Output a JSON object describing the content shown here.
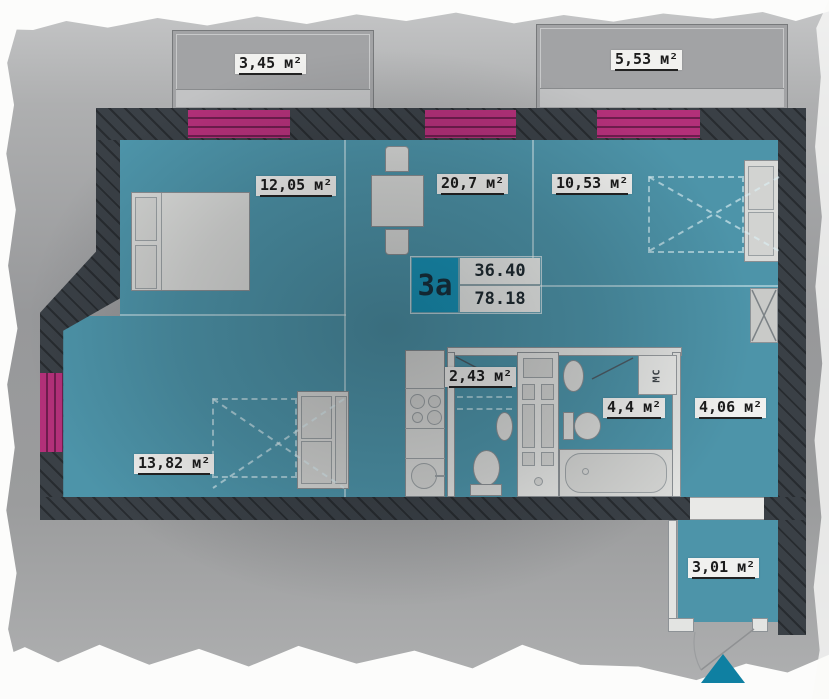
{
  "plan": {
    "unit_box": {
      "unit": "3а",
      "value_top": "36.40",
      "value_bottom": "78.18"
    },
    "labels": {
      "balcony_left": "3,45 м²",
      "balcony_right": "5,53 м²",
      "bedroom_left": "12,05 м²",
      "living_room": "20,7 м²",
      "bedroom_right": "10,53 м²",
      "wc": "2,43 м²",
      "bathroom": "4,4 м²",
      "hallway": "4,06 м²",
      "room_bottom_left": "13,82 м²",
      "entry": "3,01 м²",
      "utility_box": "МС"
    },
    "colors": {
      "floor": "#4d94a9",
      "wall": "#3a4046",
      "window": "#b33079",
      "window_line": "#6e1c4d",
      "accent": "#1795ba",
      "accent_dark": "#0f80a2",
      "balcony": "#a2a3a5",
      "label_bg": "#f1f1ef",
      "label_text": "#1c1c1c",
      "furniture": "#d9dad8",
      "furniture_border": "#898e92"
    }
  }
}
